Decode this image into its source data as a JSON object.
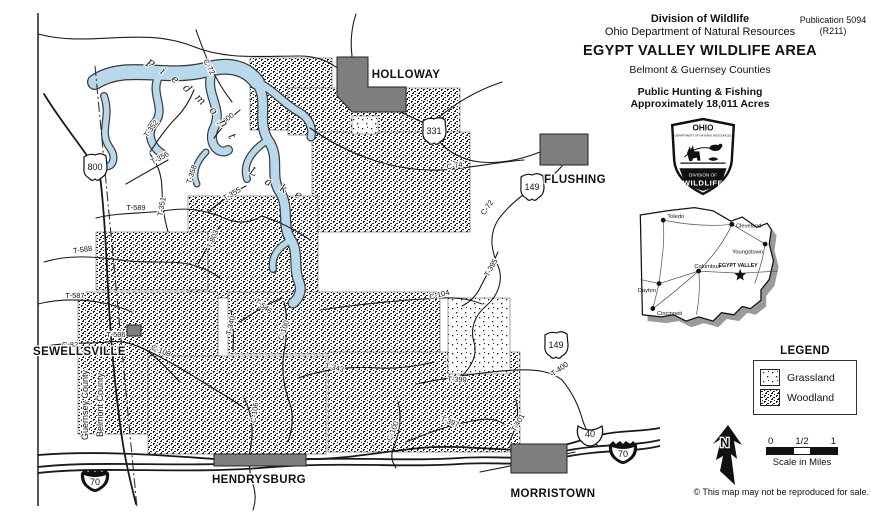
{
  "header": {
    "agency_line1": "Division of Wildlife",
    "agency_line2": "Ohio Department of Natural Resources",
    "publication_line1": "Publication 5094",
    "publication_line2": "(R211)",
    "title": "EGYPT VALLEY WILDLIFE AREA",
    "subtitle": "Belmont & Guernsey Counties",
    "info_line1": "Public Hunting & Fishing",
    "info_line2": "Approximately 18,011 Acres"
  },
  "badge": {
    "state": "OHIO",
    "department": "DEPARTMENT OF NATURAL RESOURCES",
    "division_line1": "DIVISION OF",
    "division_line2": "WILDLIFE"
  },
  "inset": {
    "cities": [
      {
        "label": "Toledo",
        "x": 30,
        "y": 21,
        "lx": 34,
        "ly": 19,
        "anchor": "start"
      },
      {
        "label": "Cleveland",
        "x": 96,
        "y": 25,
        "lx": 100,
        "ly": 28,
        "anchor": "start"
      },
      {
        "label": "Youngstown",
        "x": 128,
        "y": 44,
        "lx": 126,
        "ly": 53,
        "anchor": "end"
      },
      {
        "label": "Columbus",
        "x": 64,
        "y": 70,
        "lx": 60,
        "ly": 67,
        "anchor": "start"
      },
      {
        "label": "Dayton",
        "x": 26,
        "y": 82,
        "lx": 23,
        "ly": 90,
        "anchor": "end"
      },
      {
        "label": "Cincinnati",
        "x": 20,
        "y": 106,
        "lx": 24,
        "ly": 112,
        "anchor": "start"
      }
    ],
    "star": {
      "label": "EGYPT VALLEY",
      "x": 104,
      "y": 74
    }
  },
  "legend": {
    "title": "LEGEND",
    "items": [
      {
        "label": "Grassland",
        "pattern": "grass"
      },
      {
        "label": "Woodland",
        "pattern": "wood"
      }
    ]
  },
  "north_label": "N",
  "scale": {
    "ticks": [
      "0",
      "1/2",
      "1"
    ],
    "label": "Scale in Miles"
  },
  "copyright": "© This map may not be reproduced for sale.",
  "map": {
    "colors": {
      "lake": "#b8d9ec",
      "town": "#7e7e7e"
    },
    "lake_name_word1": "Piedmont",
    "lake_name_word2": "Lake",
    "county_boundary": {
      "left": "Guernsey County",
      "right": "Belmont County"
    },
    "towns": [
      {
        "name": "HOLLOWAY",
        "x": 406,
        "y": 78,
        "anchor": "middle"
      },
      {
        "name": "FLUSHING",
        "x": 575,
        "y": 183,
        "anchor": "middle"
      },
      {
        "name": "SEWELLSVILLE",
        "x": 33,
        "y": 355,
        "anchor": "start"
      },
      {
        "name": "HENDRYSBURG",
        "x": 259,
        "y": 483,
        "anchor": "middle"
      },
      {
        "name": "MORRISTOWN",
        "x": 553,
        "y": 497,
        "anchor": "middle"
      }
    ],
    "shields": [
      {
        "type": "ohio",
        "label": "800",
        "x": 95,
        "y": 167
      },
      {
        "type": "ohio",
        "label": "331",
        "x": 434,
        "y": 131
      },
      {
        "type": "ohio",
        "label": "149",
        "x": 532,
        "y": 187
      },
      {
        "type": "ohio",
        "label": "149",
        "x": 556,
        "y": 345
      },
      {
        "type": "us",
        "label": "40",
        "x": 590,
        "y": 434
      },
      {
        "type": "interstate",
        "label": "70",
        "x": 95,
        "y": 479
      },
      {
        "type": "interstate",
        "label": "70",
        "x": 623,
        "y": 451
      }
    ],
    "road_labels": [
      {
        "label": "C-72",
        "x": 207,
        "y": 68,
        "rot": 62
      },
      {
        "label": "T-600",
        "x": 227,
        "y": 122,
        "rot": -38
      },
      {
        "label": "T-352",
        "x": 153,
        "y": 130,
        "rot": -55
      },
      {
        "label": "T-356",
        "x": 161,
        "y": 160,
        "rot": -28
      },
      {
        "label": "T-358",
        "x": 194,
        "y": 175,
        "rot": -72
      },
      {
        "label": "T-351",
        "x": 164,
        "y": 207,
        "rot": -80
      },
      {
        "label": "T-355",
        "x": 233,
        "y": 196,
        "rot": -30
      },
      {
        "label": "T-803",
        "x": 215,
        "y": 240,
        "rot": -68
      },
      {
        "label": "T-589",
        "x": 136,
        "y": 210,
        "rot": 0
      },
      {
        "label": "T-588",
        "x": 83,
        "y": 252,
        "rot": -8
      },
      {
        "label": "T-587",
        "x": 75,
        "y": 298,
        "rot": 0
      },
      {
        "label": "T-586",
        "x": 116,
        "y": 337,
        "rot": 0
      },
      {
        "label": "C-82",
        "x": 70,
        "y": 347,
        "rot": 0
      },
      {
        "label": "C-108",
        "x": 160,
        "y": 353,
        "rot": 22
      },
      {
        "label": "T-546",
        "x": 262,
        "y": 308,
        "rot": 38
      },
      {
        "label": "T-340",
        "x": 233,
        "y": 326,
        "rot": -78
      },
      {
        "label": "C-100",
        "x": 286,
        "y": 331,
        "rot": -72
      },
      {
        "label": "T-343",
        "x": 334,
        "y": 370,
        "rot": 12
      },
      {
        "label": "C-106",
        "x": 257,
        "y": 413,
        "rot": -82
      },
      {
        "label": "C-100",
        "x": 395,
        "y": 432,
        "rot": -68
      },
      {
        "label": "C-74",
        "x": 455,
        "y": 168,
        "rot": -10
      },
      {
        "label": "C-72",
        "x": 489,
        "y": 209,
        "rot": -55
      },
      {
        "label": "T-395",
        "x": 493,
        "y": 269,
        "rot": -60
      },
      {
        "label": "C-104",
        "x": 440,
        "y": 297,
        "rot": -14
      },
      {
        "label": "T-399",
        "x": 457,
        "y": 382,
        "rot": 2
      },
      {
        "label": "T-400",
        "x": 561,
        "y": 371,
        "rot": -35
      },
      {
        "label": "T-397",
        "x": 449,
        "y": 424,
        "rot": 20
      },
      {
        "label": "T-401",
        "x": 520,
        "y": 424,
        "rot": -60
      }
    ]
  }
}
